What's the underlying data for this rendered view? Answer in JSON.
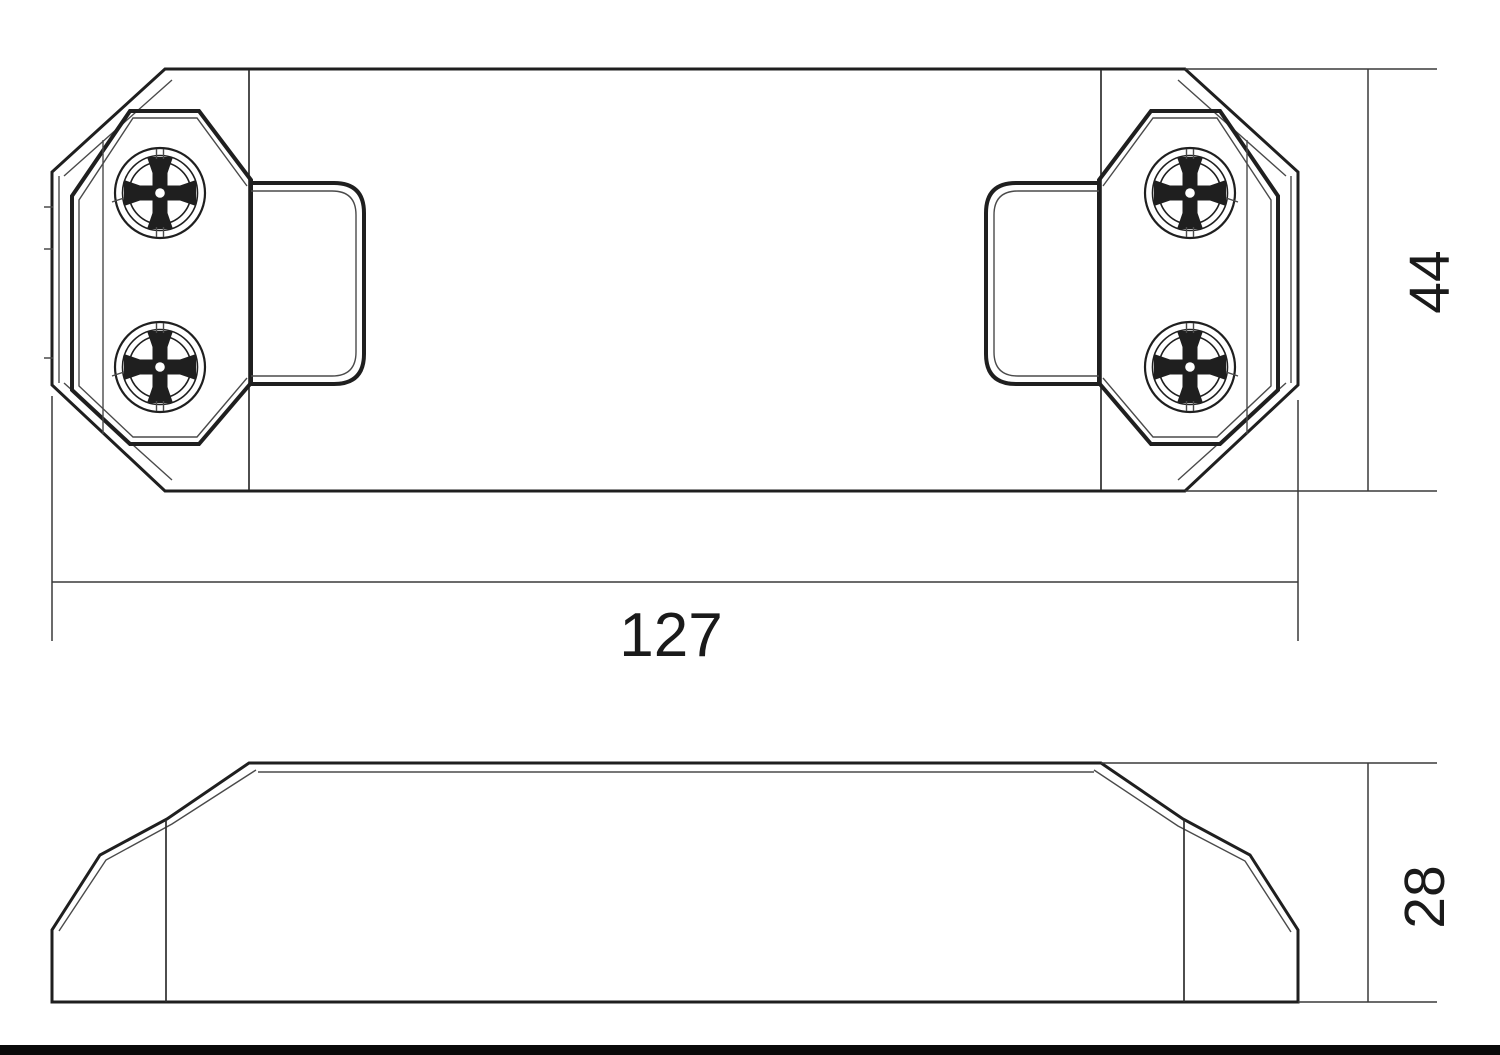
{
  "colors": {
    "background": "#ffffff",
    "line": "#1f1f1f",
    "dimension_line": "#3a3a3a",
    "text": "#1a1a1a"
  },
  "dimensions": {
    "width": "127",
    "height": "44",
    "depth": "28"
  }
}
